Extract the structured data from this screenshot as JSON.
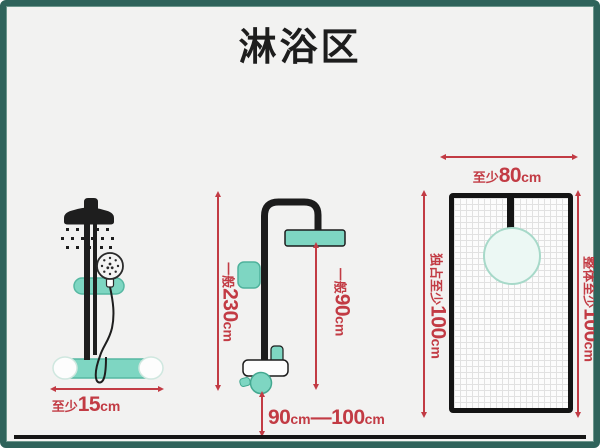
{
  "title": "淋浴区",
  "colors": {
    "frame_green": "#2f635b",
    "fixture_teal": "#7ed6c2",
    "dim_red": "#c23b44",
    "line_black": "#161616"
  },
  "front_view": {
    "valve_spacing_label": {
      "prefix": "至少",
      "value": "15",
      "unit": "cm"
    },
    "pipe_height_label": {
      "prefix": "一般",
      "value": "230",
      "unit": "cm"
    },
    "head_height_label": {
      "prefix": "一般",
      "value": "90",
      "unit": "cm"
    },
    "valve_floor_distance_label": {
      "min_value": "90",
      "min_unit": "cm",
      "separator": "—",
      "max_value": "100",
      "max_unit": "cm"
    }
  },
  "top_view": {
    "width_label": {
      "prefix": "至少",
      "value": "80",
      "unit": "cm"
    },
    "exclusive_depth_label": {
      "prefix": "独占至少",
      "value": "100",
      "unit": "cm"
    },
    "overall_depth_label": {
      "prefix": "整体至少",
      "value": "100",
      "unit": "cm"
    }
  }
}
